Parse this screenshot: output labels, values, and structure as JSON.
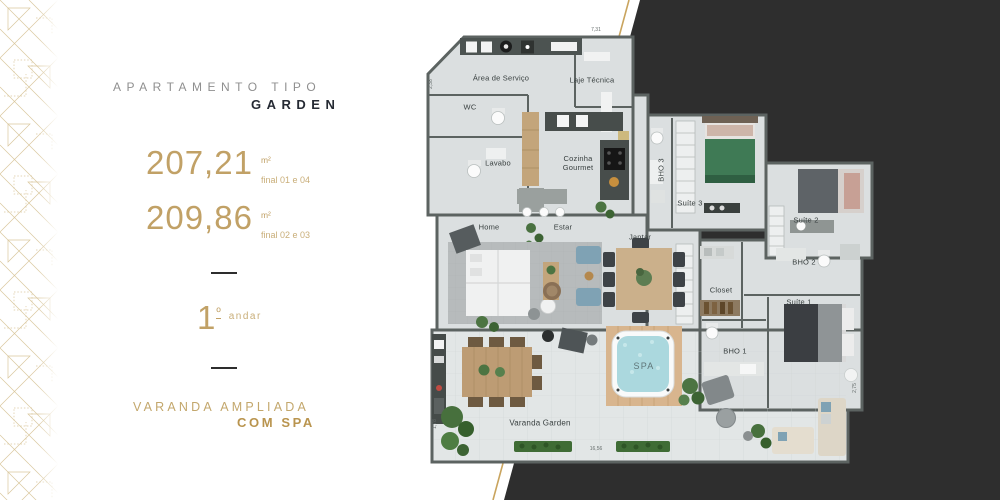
{
  "left_panel": {
    "title_small": "APARTAMENTO TIPO",
    "title_big": "GARDEN",
    "areas": [
      {
        "value": "207,21",
        "unit": "m²",
        "note": "final 01 e 04"
      },
      {
        "value": "209,86",
        "unit": "m²",
        "note": "final 02 e 03"
      }
    ],
    "floor": {
      "number": "1",
      "ordinal": "º",
      "label": "andar"
    },
    "tagline_line1": "VARANDA AMPLIADA",
    "tagline_line2": "COM SPA"
  },
  "floorplan": {
    "rooms": {
      "area_servico": "Área de Serviço",
      "laje_tecnica": "Laje Técnica",
      "wc": "WC",
      "lavabo": "Lavabo",
      "cozinha": "Cozinha Gourmet",
      "bho3": "BHO 3",
      "suite3": "Suíte 3",
      "suite2": "Suíte 2",
      "bho2": "BHO 2",
      "closet": "Closet",
      "home": "Home",
      "estar": "Estar",
      "jantar": "Jantar",
      "bho1": "BHO 1",
      "suite1": "Suíte 1",
      "spa": "SPA",
      "varanda": "Varanda Garden"
    },
    "dimensions": {
      "top": "7,31",
      "bottom": "16,56",
      "right": "2,75",
      "left_bottom": "1,78",
      "left_top": "2,38"
    }
  },
  "colors": {
    "gold": "#c1a166",
    "gold_line": "#c9a45e",
    "dark_backdrop": "#2e2e2e",
    "wall": "#5c6361",
    "floor": "#dbdfe0",
    "spa_water": "#abd8de"
  }
}
